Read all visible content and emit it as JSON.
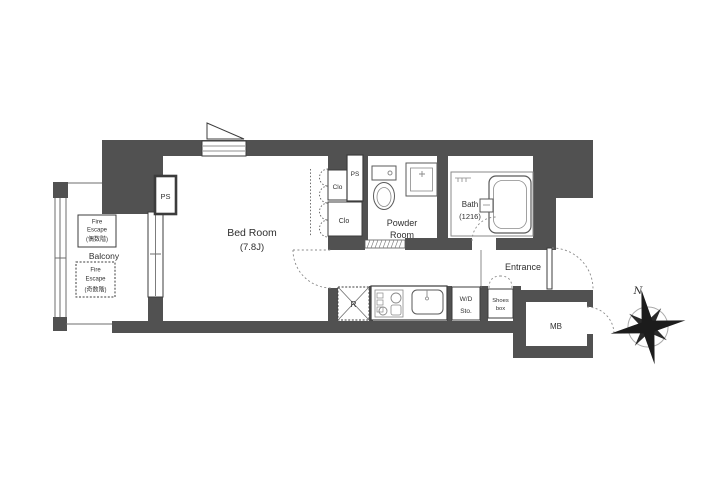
{
  "floor_plan": {
    "bedroom": {
      "name": "Bed Room",
      "size": "(7.8J)"
    },
    "closets": {
      "upper": "Clo",
      "lower": "Clo"
    },
    "pipe_spaces": {
      "near_balcony": "PS",
      "near_closet": "PS"
    },
    "powder_room": {
      "name_line1": "Powder",
      "name_line2": "Room"
    },
    "bath": {
      "name": "Bath",
      "size": "(1216)"
    },
    "entrance": {
      "name": "Entrance"
    },
    "shoes_box": {
      "line1": "Shoes",
      "line2": "box"
    },
    "washer_dryer_storage": {
      "line1": "W/D",
      "line2": "Sto."
    },
    "refrigerator_space": {
      "label": "R"
    },
    "meter_box": {
      "label": "MB"
    },
    "balcony": {
      "name": "Balcony",
      "fire_escape_even": {
        "line1": "Fire",
        "line2": "Escape",
        "line3": "(偶数階)"
      },
      "fire_escape_odd": {
        "line1": "Fire",
        "line2": "Escape",
        "line3": "(奇数階)"
      }
    },
    "compass": {
      "north": "N"
    },
    "colors": {
      "wall": "#515151",
      "line": "#3c3c3c",
      "text": "#2f2f2f"
    }
  }
}
